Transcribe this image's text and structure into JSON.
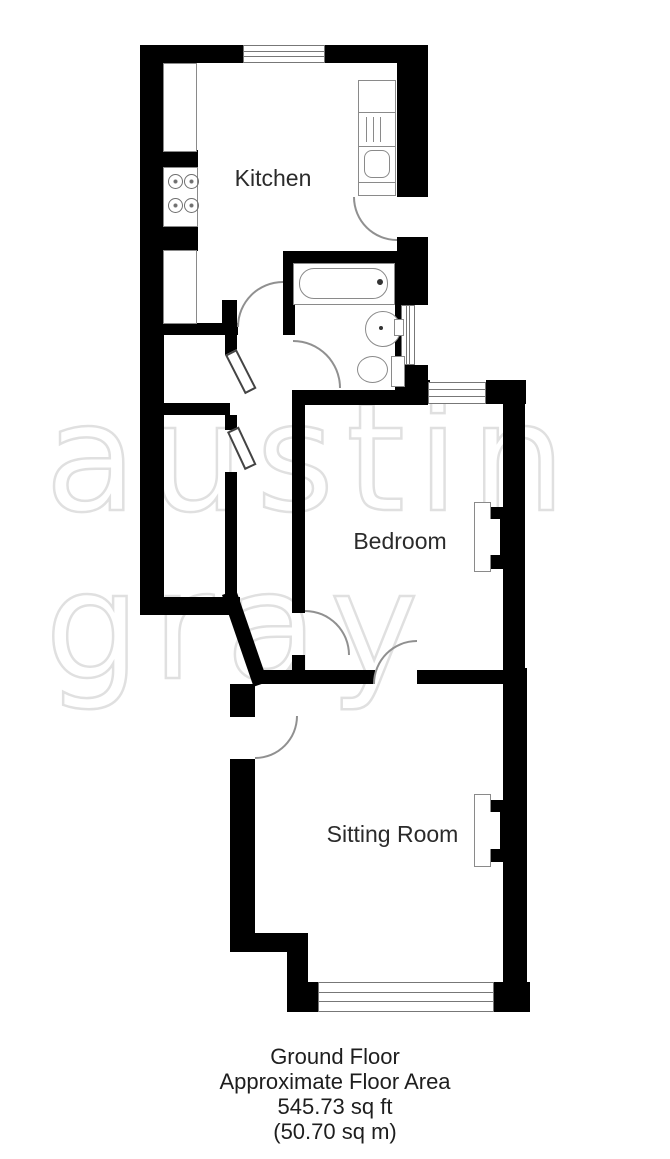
{
  "floorplan": {
    "rooms": {
      "kitchen": {
        "label": "Kitchen"
      },
      "bedroom": {
        "label": "Bedroom"
      },
      "sitting_room": {
        "label": "Sitting Room"
      }
    },
    "fixtures": [
      "hob",
      "worktop",
      "cupboard",
      "sink-drainer",
      "bath",
      "basin",
      "toilet",
      "fireplace-bedroom",
      "fireplace-sitting-room"
    ],
    "windows": [
      "kitchen-top",
      "bathroom-right",
      "bedroom-top",
      "sitting-room-bottom"
    ],
    "doors": [
      "kitchen-side-door",
      "kitchen-hall-door",
      "bathroom-door",
      "bedroom-hall-door",
      "bedroom-sitting-door",
      "sitting-room-door"
    ],
    "colors": {
      "wall": "#000000",
      "fixture_outline": "#8a8a8a",
      "label_text": "#2b2b2b",
      "watermark": "#e0e0e0",
      "background": "#ffffff"
    }
  },
  "watermark": {
    "line1": "austin",
    "line2": "gray"
  },
  "footer": {
    "lines": [
      "Ground Floor",
      "Approximate Floor Area",
      "545.73 sq ft",
      "(50.70 sq m)"
    ]
  }
}
